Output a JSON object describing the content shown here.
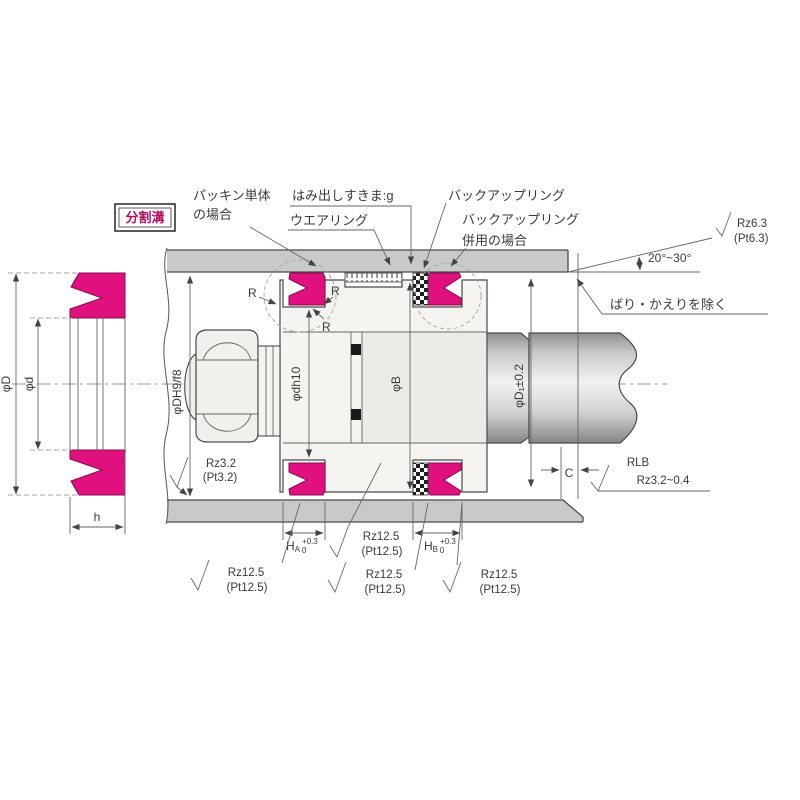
{
  "annotations": {
    "split_groove": "分割溝",
    "packing_single": {
      "line1": "パッキン単体",
      "line2": "の場合"
    },
    "extrusion_gap": "はみ出しすきま:g",
    "wear_ring": "ウエアリング",
    "backup_ring": "バックアップリング",
    "backup_combined": {
      "line1": "バックアップリング",
      "line2": "併用の場合"
    },
    "chamfer_angle": "20°~30°",
    "deburr": "ばり・かえりを除く",
    "fillet_r": "R"
  },
  "dimensions": {
    "seal_od": "φD",
    "seal_id": "φd",
    "seal_height": "h",
    "bore_dia": "φDH9/f8",
    "groove_dia": "φdh10",
    "land_dia": "φB",
    "rod_dia": "φD₁±0.2",
    "chamfer_len": "C",
    "groove_a": {
      "base": "H",
      "sub": "A",
      "tol_up": "+0.3",
      "tol_dn": "0"
    },
    "groove_b": {
      "base": "H",
      "sub": "B",
      "tol_up": "+0.3",
      "tol_dn": "0"
    }
  },
  "roughness": {
    "chamfer_top": {
      "l1": "Rz6.3",
      "l2": "(Pt6.3)"
    },
    "bore_surface": {
      "l1": "Rz3.2",
      "l2": "(Pt3.2)"
    },
    "lead_in": {
      "l1": "RLB",
      "l2": "Rz3.2~0.4"
    },
    "groove_mid": {
      "l1": "Rz12.5",
      "l2": "(Pt12.5)"
    },
    "groove_left": {
      "l1": "Rz12.5",
      "l2": "(Pt12.5)"
    },
    "groove_center": {
      "l1": "Rz12.5",
      "l2": "(Pt12.5)"
    },
    "groove_right": {
      "l1": "Rz12.5",
      "l2": "(Pt12.5)"
    }
  },
  "colors": {
    "seal": "#E0107E",
    "seal_outline": "#8B0A4E",
    "metal_gray": "#C9C9C9",
    "label_accent": "#B01060"
  }
}
